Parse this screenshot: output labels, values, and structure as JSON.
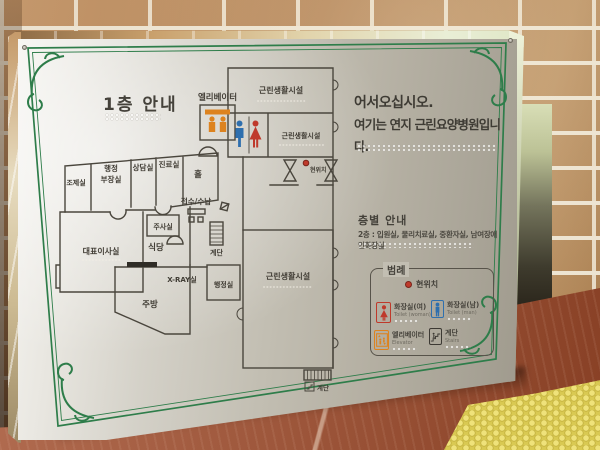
{
  "colors": {
    "border_green": "#2e7d4a",
    "panel_grey": "#c2beb2",
    "brick_tan": "#c49a6a",
    "floor_red": "#a24f30",
    "paving_yellow": "#d9c952",
    "icon_red": "#bf392b",
    "icon_blue": "#2e6fae",
    "icon_orange": "#dd831f",
    "marker_red": "#bf3a2b"
  },
  "sign": {
    "title": "1층 안내",
    "welcome": {
      "line1": "어서오십시오.",
      "line2": "여기는 연지 근린요양병원입니다."
    },
    "floor_guide": {
      "heading": "층별 안내",
      "line": "2층 : 입원실, 물리치료실, 중환자실, 남여장애인화장실"
    },
    "legend": {
      "title": "범례",
      "current_location": "현위치",
      "items": [
        {
          "icon": "woman-icon",
          "label": "화장실(여)",
          "sublabel": "Toilet (woman)",
          "color": "#bf392b"
        },
        {
          "icon": "man-icon",
          "label": "화장실(남)",
          "sublabel": "Toilet (man)",
          "color": "#2e6fae"
        },
        {
          "icon": "elevator-icon",
          "label": "엘리베이터",
          "sublabel": "Elevator",
          "color": "#dd831f"
        },
        {
          "icon": "stairs-icon",
          "label": "계단",
          "sublabel": "Stairs",
          "color": "#3c3933"
        }
      ]
    },
    "map": {
      "elevator": "엘리베이터",
      "facility_top": "근린생활시설",
      "facility_mid": "근린생활시설",
      "facility_bottom": "근린생활시설",
      "current_location": "현위치",
      "dispensary": "조제실",
      "admin_director_1": "행정",
      "admin_director_2": "부장실",
      "counseling": "상담실",
      "clinic": "진료실",
      "hall": "홀",
      "reception": "접수/수납",
      "injection": "주사실",
      "ceo_office": "대표이사실",
      "dining": "식당",
      "stairs_mid": "계단",
      "xray": "X-RAY실",
      "admin_office": "행정실",
      "kitchen": "주방",
      "stairs_bottom": "계단"
    }
  }
}
